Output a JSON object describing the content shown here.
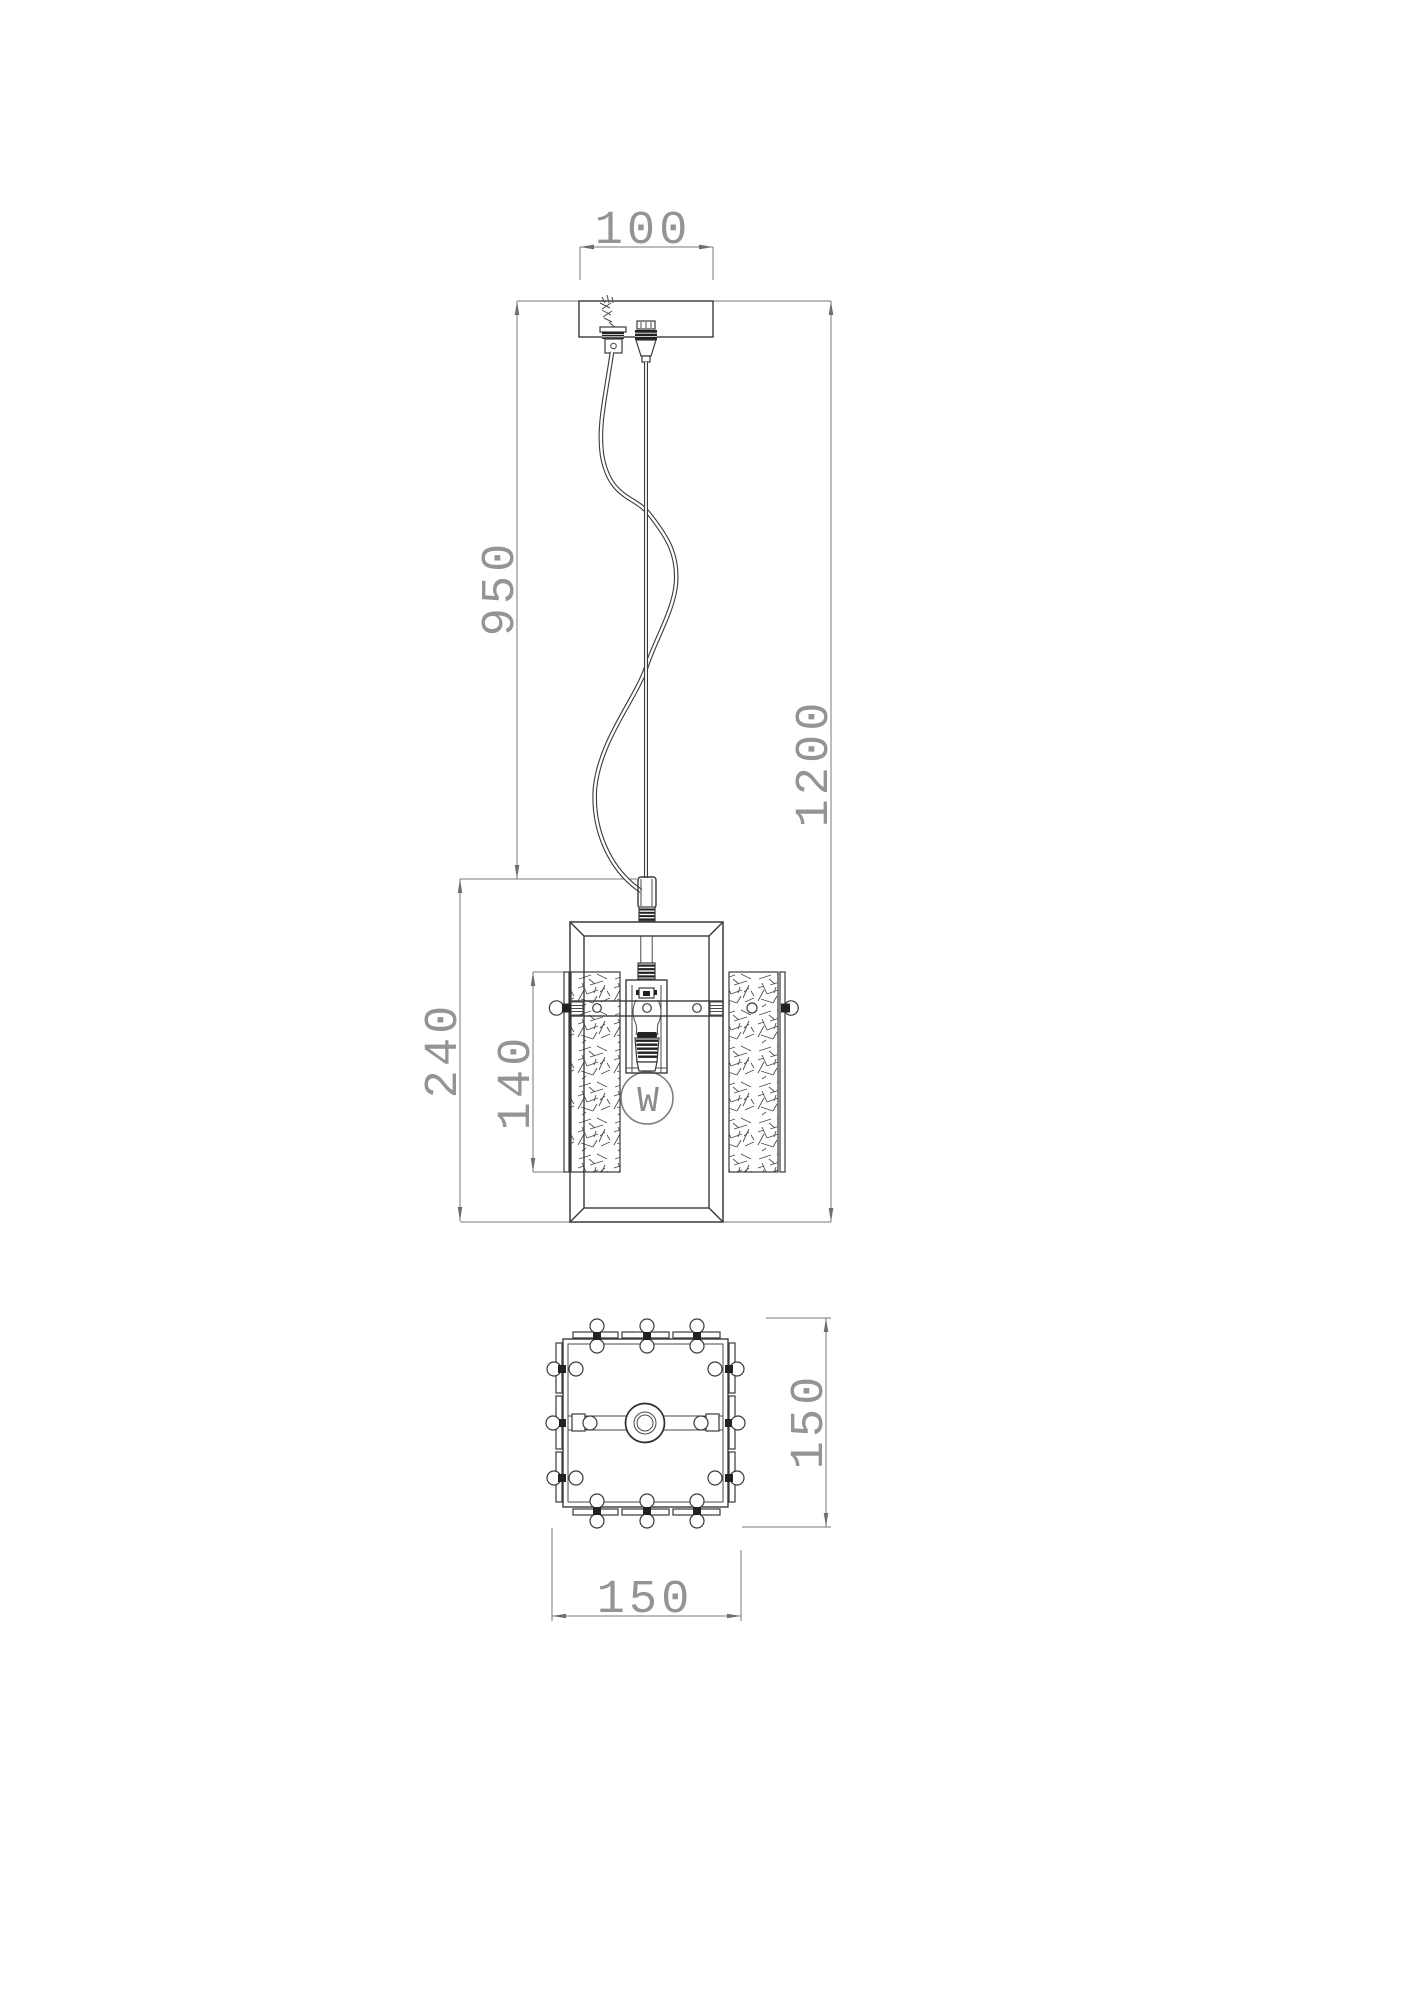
{
  "front": {
    "view_name": "front-elevation",
    "canopy_width": "100",
    "cord_length": "950",
    "overall_height": "1200",
    "body_height": "240",
    "glass_height": "140",
    "bulb_letter": "W"
  },
  "bottom": {
    "view_name": "bottom-plan",
    "depth": "150",
    "width": "150"
  },
  "colors": {
    "background": "#ffffff",
    "object_line": "#3a3a3a",
    "dimension_line": "#787878",
    "text": "#949494"
  }
}
